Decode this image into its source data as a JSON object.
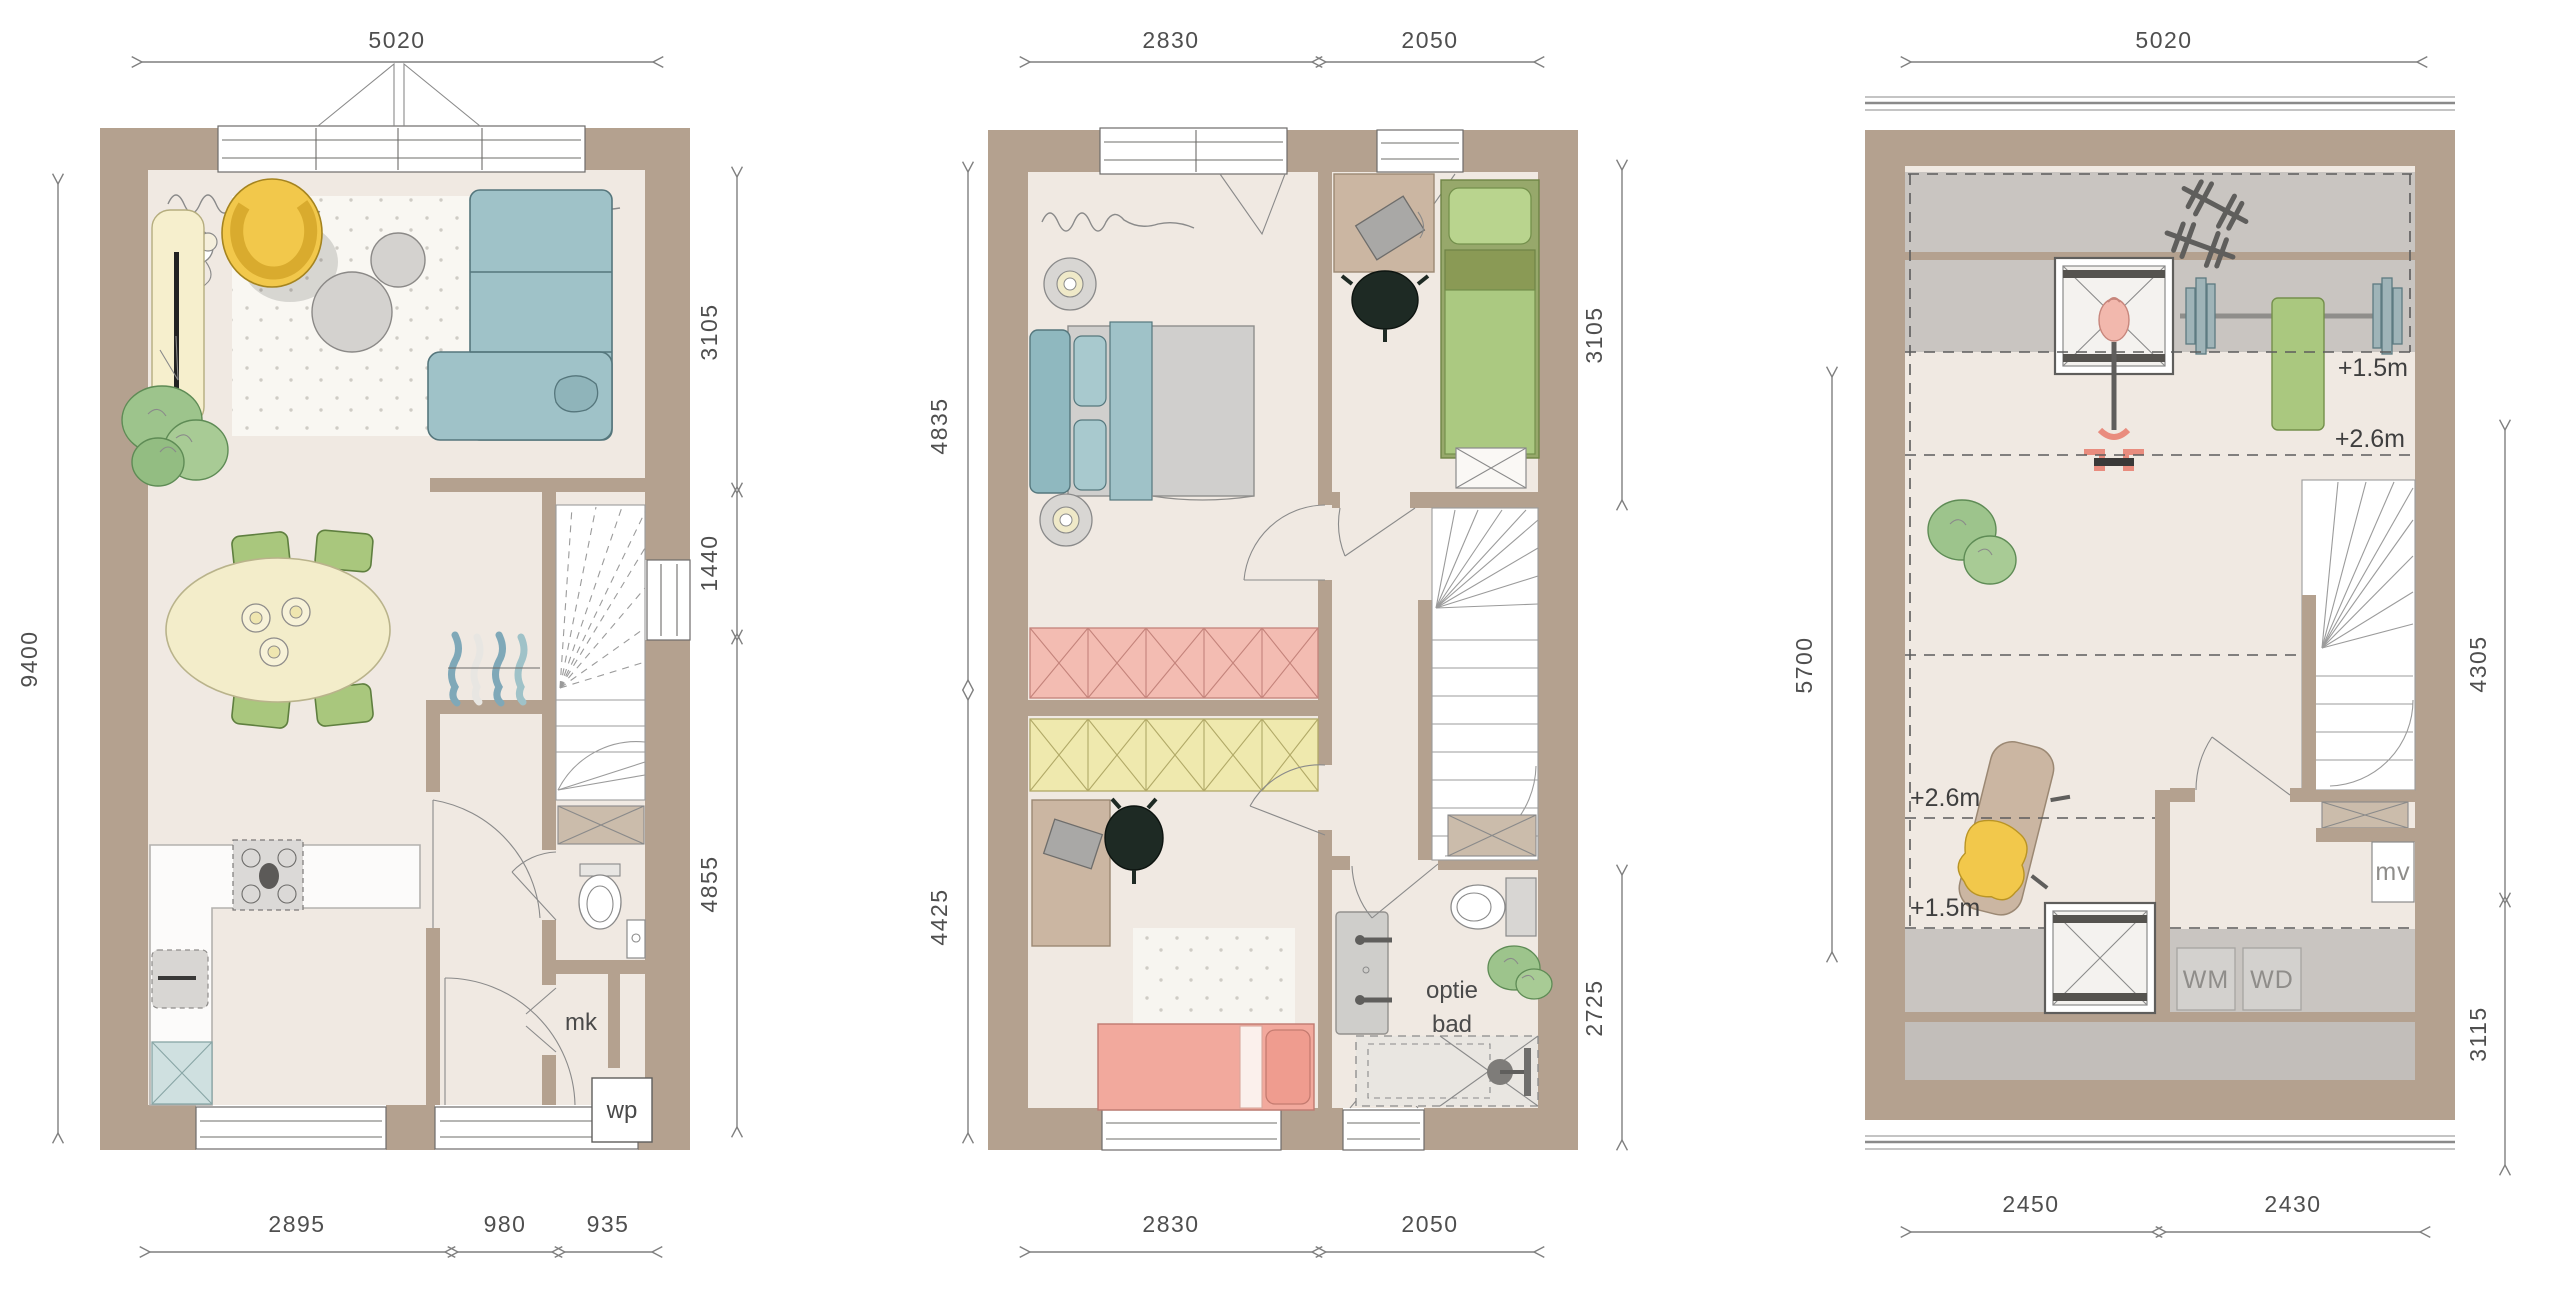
{
  "document": {
    "type": "architectural-floor-plans",
    "units": "mm"
  },
  "colors": {
    "wall": "#b4a18f",
    "floor": "#f0e9e2",
    "low_headroom_gray": "#c9c5c1",
    "sofa_blue": "#9fc2c8",
    "accent_yellow": "#f2c84b",
    "accent_green": "#a9c77d",
    "wardrobe_pink": "#f3bcb2",
    "wardrobe_yellow": "#efe9ae",
    "bed_pink": "#f2a99d",
    "dimension_text": "#4f4f4f"
  },
  "plans": [
    {
      "id": "ground-floor",
      "dims": {
        "top": [
          "5020"
        ],
        "left": [
          "9400"
        ],
        "right": [
          "3105",
          "1440",
          "4855"
        ],
        "bottom": [
          "2895",
          "980",
          "935"
        ]
      },
      "labels": {
        "mk": "mk",
        "wp": "wp"
      }
    },
    {
      "id": "first-floor",
      "dims": {
        "top": [
          "2830",
          "2050"
        ],
        "left": [
          "4835",
          "4425"
        ],
        "right": [
          "3105",
          "2725"
        ],
        "bottom": [
          "2830",
          "2050"
        ]
      },
      "labels": {
        "optie": "optie",
        "bad": "bad"
      }
    },
    {
      "id": "attic-floor",
      "dims": {
        "top": [
          "5020"
        ],
        "left": [
          "5700"
        ],
        "right": [
          "4305",
          "3115"
        ],
        "bottom": [
          "2450",
          "2430"
        ]
      },
      "labels": {
        "h15_upper": "+1.5m",
        "h26_upper": "+2.6m",
        "h26_lower": "+2.6m",
        "h15_lower": "+1.5m",
        "mv": "mv",
        "wm": "WM",
        "wd": "WD"
      }
    }
  ]
}
